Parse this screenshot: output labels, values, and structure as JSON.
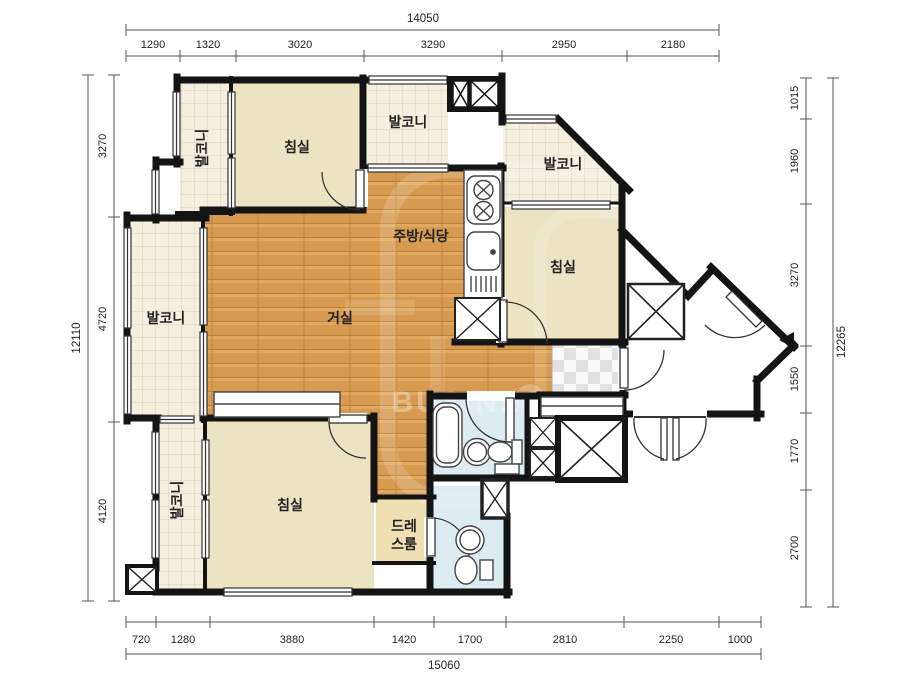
{
  "floorplan": {
    "title": "아파트 평면도",
    "labels": {
      "bedroom": "침실",
      "balcony": "발코니",
      "living": "거실",
      "kitchen_dining": "주방/식당",
      "dressroom_line1": "드레",
      "dressroom_line2": "스룸"
    },
    "watermark": {
      "text": "BUSINESS PLATFORM"
    },
    "colors": {
      "wall": "#141414",
      "wood_floor": "#d69a50",
      "bedroom_fill": "#ece3c2",
      "balcony_tile": "#f5efdf",
      "bathroom_fill": "#dcecf0",
      "dressroom_fill": "#f1dfb4",
      "entry_checker": "#e2e2e2"
    },
    "dimensions": {
      "top": {
        "total": "14050",
        "segments": [
          "1290",
          "1320",
          "3020",
          "3290",
          "2950",
          "2180"
        ]
      },
      "bottom": {
        "total": "15060",
        "segments": [
          "720",
          "1280",
          "3880",
          "1420",
          "1700",
          "2810",
          "2250",
          "1000"
        ]
      },
      "left": {
        "total": "12110",
        "segments": [
          "3270",
          "4720",
          "4120"
        ]
      },
      "right": {
        "total": "12265",
        "segments": [
          "1015",
          "1960",
          "3270",
          "1550",
          "1770",
          "2700"
        ]
      }
    }
  }
}
